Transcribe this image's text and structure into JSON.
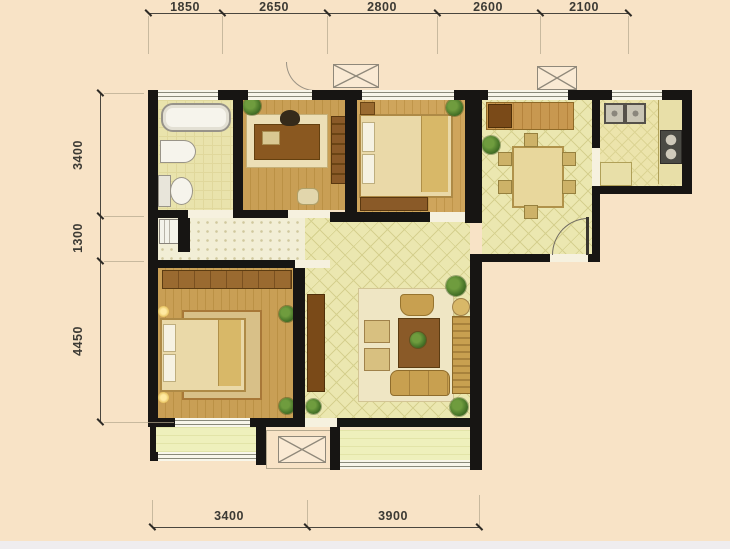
{
  "plan": {
    "title": "apartment-floor-plan",
    "dimensions_top": [
      "1850",
      "2650",
      "2800",
      "2600",
      "2100"
    ],
    "dimensions_left": [
      "3400",
      "1300",
      "4450"
    ],
    "dimensions_bottom": [
      "3400",
      "3900"
    ]
  },
  "colors": {
    "background": "#f8e3c6",
    "wall": "#171513",
    "wood_floor": "#c99f55",
    "tile_floor": "#ebe7b0",
    "hall_floor": "#f2eed6",
    "balcony_floor": "#eef0bc",
    "furniture_wood": "#8a5a28",
    "dimension_text": "#3c3a34"
  },
  "icons": {
    "bathtub": "rounded-rect",
    "wash-basin": "half-oval",
    "toilet": "tank-and-bowl",
    "washing-machine": "box",
    "desk": "rect",
    "office-chair": "rounded-rect",
    "bookshelf": "shelved-rect",
    "double-bed": "rect-with-pillows",
    "wardrobe": "striped-rect",
    "dining-table": "rect-with-chairs",
    "refrigerator": "square",
    "kitchen-sink": "double-square",
    "stove": "dark-rect-two-burners",
    "sofa": "cushioned-rect",
    "armchair": "rounded-rect",
    "coffee-table": "rect-with-plant",
    "tv-cabinet": "narrow-rect",
    "sideboard": "striped-rect",
    "plant": "green-circle",
    "floor-lamp": "glow-circle",
    "ac-platform": "x-crossed-box",
    "door-swing": "quarter-arc"
  }
}
